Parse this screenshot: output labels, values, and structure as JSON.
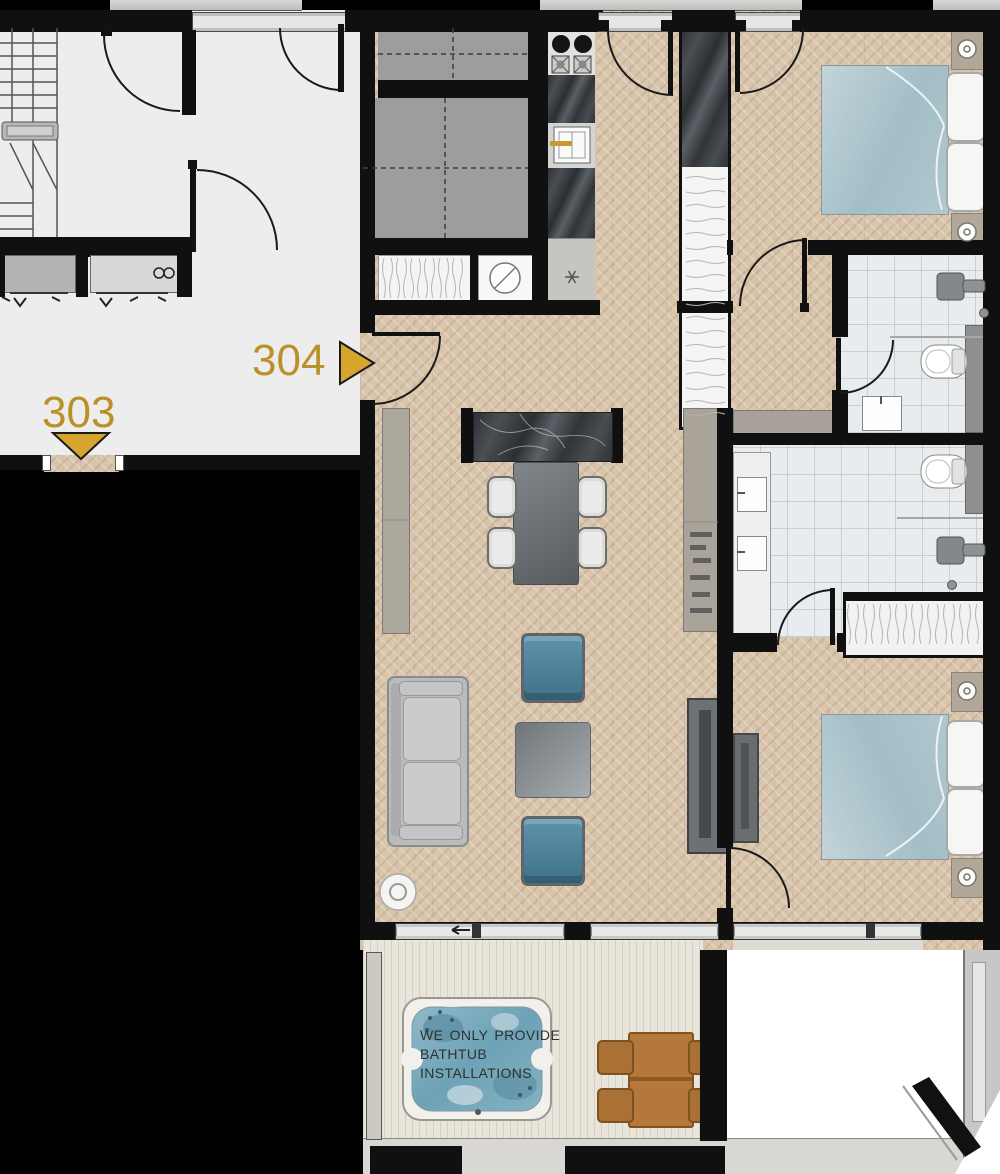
{
  "labels": {
    "left_unit": {
      "number": "303"
    },
    "main_unit": {
      "number": "304"
    }
  },
  "balcony_note": {
    "lines": [
      "WE ONLY PROVIDE",
      "BATHTUB",
      "INSTALLATIONS"
    ]
  },
  "icons": [
    "staircase",
    "elevator",
    "stove",
    "kitchen-sink",
    "washing-machine",
    "wardrobe",
    "double-bed",
    "nightstand-lamp",
    "toilet",
    "shower",
    "bathroom-sink",
    "double-vanity",
    "sofa",
    "armchair",
    "coffee-table",
    "dining-table",
    "dining-chair",
    "kitchen-island",
    "tv-console",
    "floor-lamp",
    "hot-tub",
    "outdoor-dining-set",
    "door-swing",
    "unit-arrow"
  ],
  "palette": {
    "gold": "#ba9129",
    "wall_black": "#101010",
    "wood_floor": "#d8c5ac",
    "deck": "#eae5da",
    "bathroom_tile": "#e9ecee",
    "hall_gray": "#ededed",
    "shaft_gray": "#9d9d9d",
    "bed_teal": "#a9c4cc",
    "armchair_blue": "#4e86a0",
    "hot_tub_water": "#7fb0c2",
    "outdoor_wood": "#b5783b"
  }
}
